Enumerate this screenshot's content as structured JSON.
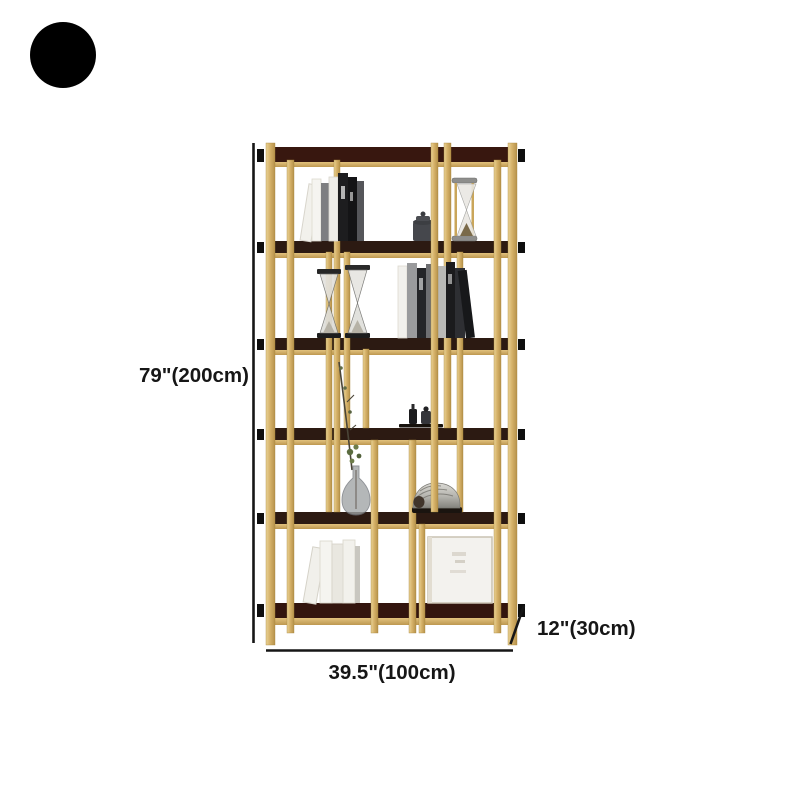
{
  "page": {
    "background_color": "#ffffff"
  },
  "badge": {
    "color": "#000000"
  },
  "dimensions": {
    "height_label": "79\"(200cm)",
    "width_label": "39.5\"(100cm)",
    "depth_label": "12\"(30cm)",
    "line_color": "#161616",
    "text_color": "#161616"
  },
  "product": {
    "kind": "etagere-bookshelf",
    "frame_color": "#d6b269",
    "shelf_color": "#2c1a12",
    "shelf_count": 6,
    "decor_items": [
      "books",
      "storage-jar",
      "gold-hourglass",
      "dark-hourglasses",
      "bud-vase-with-branch",
      "nautilus-shell",
      "leaning-books",
      "blank-canvas"
    ]
  }
}
